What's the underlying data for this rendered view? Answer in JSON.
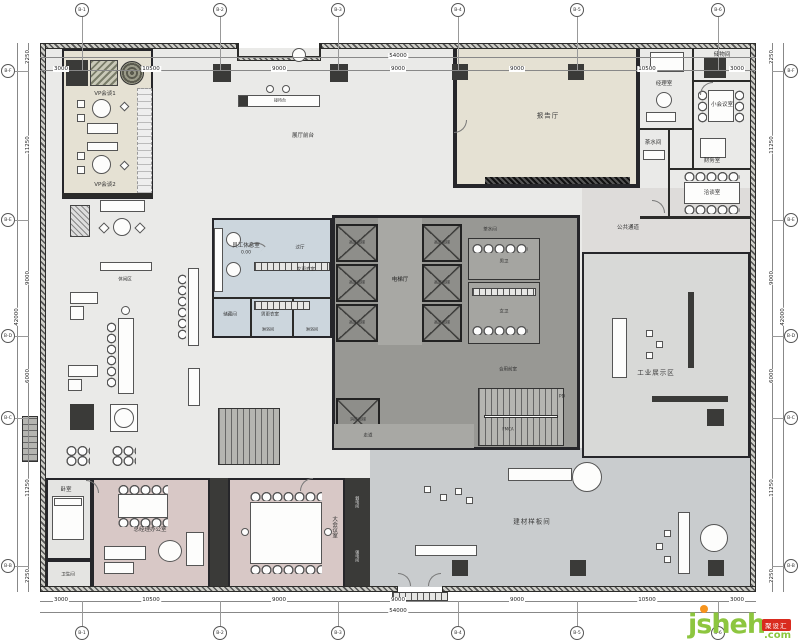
{
  "watermark": {
    "brand": "jsheh",
    "tld": ".com",
    "badge": "聚设汇"
  },
  "dimensions": {
    "top": {
      "total": "54000",
      "segments": [
        "3000",
        "10500",
        "9000",
        "9000",
        "9000",
        "10500",
        "3000"
      ]
    },
    "bottom": {
      "total": "54000",
      "segments": [
        "3000",
        "10500",
        "9000",
        "9000",
        "9000",
        "10500",
        "3000"
      ]
    },
    "left": {
      "total": "42000",
      "segments": [
        "2250",
        "11250",
        "9000",
        "6000",
        "11250",
        "2250"
      ]
    },
    "right": {
      "total": "42000",
      "segments": [
        "2250",
        "11250",
        "9000",
        "6000",
        "11250",
        "2250"
      ]
    }
  },
  "grid": {
    "columns": [
      "B-1",
      "B-2",
      "B-3",
      "B-4",
      "B-5",
      "B-6"
    ],
    "rows": [
      "B-F",
      "B-E",
      "B-D",
      "B-C",
      "B-B"
    ]
  },
  "rooms": {
    "vp1": "VP会谈1",
    "vp2": "VP会谈2",
    "front_desk": "接待台",
    "lobby": "展厅前台",
    "hall": "报告厅",
    "manager": "经理室",
    "storage": "储物间",
    "meeting_s": "小会议室",
    "pantry": "茶水间",
    "finance": "财务室",
    "talk": "洽谈室",
    "corridor": "公共通道",
    "staff": "员工休息室",
    "level": "0.00",
    "foyer": "过厅",
    "change_w": "女更衣室",
    "change_m": "男更衣室",
    "shower": "淋浴间",
    "store_s": "储藏间",
    "elev_hall": "电梯厅",
    "elev_hi": "高区电梯",
    "elev_fire": "消防电梯",
    "front_room": "合用前室",
    "wc_m": "男卫",
    "wc_f": "女卫",
    "walk": "走道",
    "pd": "PD",
    "fmca": "FMCA",
    "industry": "工业展示区",
    "lounge": "休闲区",
    "model": "建材样板间",
    "gm": "总经理办公室",
    "meeting_l": "大会议室",
    "bed": "卧室",
    "bath": "卫生间",
    "elec_w": "弱电间",
    "elec_s": "强电间"
  }
}
